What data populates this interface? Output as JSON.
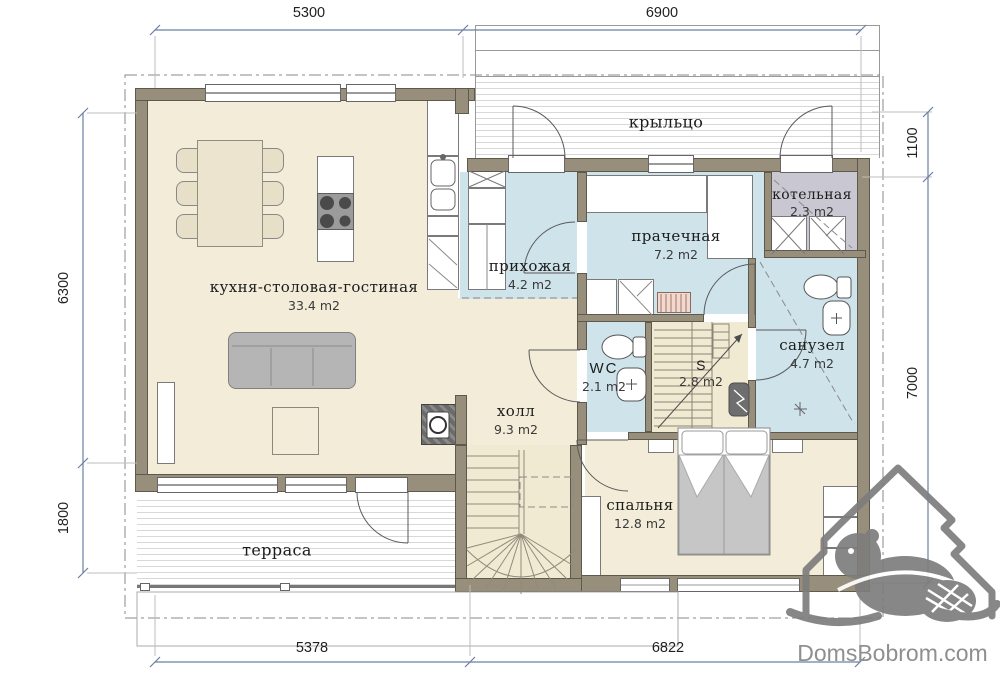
{
  "watermark": {
    "text": "DomsBobrom.com"
  },
  "dimensions": {
    "top": [
      "5300",
      "6900"
    ],
    "bottom": [
      "5378",
      "6822"
    ],
    "left": [
      "6300",
      "1800"
    ],
    "right": [
      "1100",
      "7000"
    ]
  },
  "rooms": {
    "porch": {
      "label": "крыльцо"
    },
    "boiler": {
      "label": "котельная",
      "area": "2.3 m2"
    },
    "laundry": {
      "label": "прачечная",
      "area": "7.2 m2"
    },
    "entry": {
      "label": "прихожая",
      "area": "4.2 m2"
    },
    "kitchen": {
      "label": "кухня-столовая-гостиная",
      "area": "33.4 m2"
    },
    "bathroom": {
      "label": "санузел",
      "area": "4.7 m2"
    },
    "wc": {
      "label": "WC",
      "area": "2.1 m2"
    },
    "stairs": {
      "label": "S",
      "area": "2.8 m2"
    },
    "hall": {
      "label": "холл",
      "area": "9.3 m2"
    },
    "bedroom": {
      "label": "спальня",
      "area": "12.8 m2"
    },
    "terrace": {
      "label": "терраса"
    }
  },
  "colors": {
    "wall": "#978f7b",
    "wall_edge": "#5f594c",
    "floor": "#f2ecd9",
    "wet": "#cfe3ea",
    "boiler_floor": "#c9c7d2",
    "stair_floor": "#f1ead3",
    "dim": "#6b80a4",
    "watermark": "#8f8f8f",
    "furniture_gray": "#b5b5b5"
  }
}
